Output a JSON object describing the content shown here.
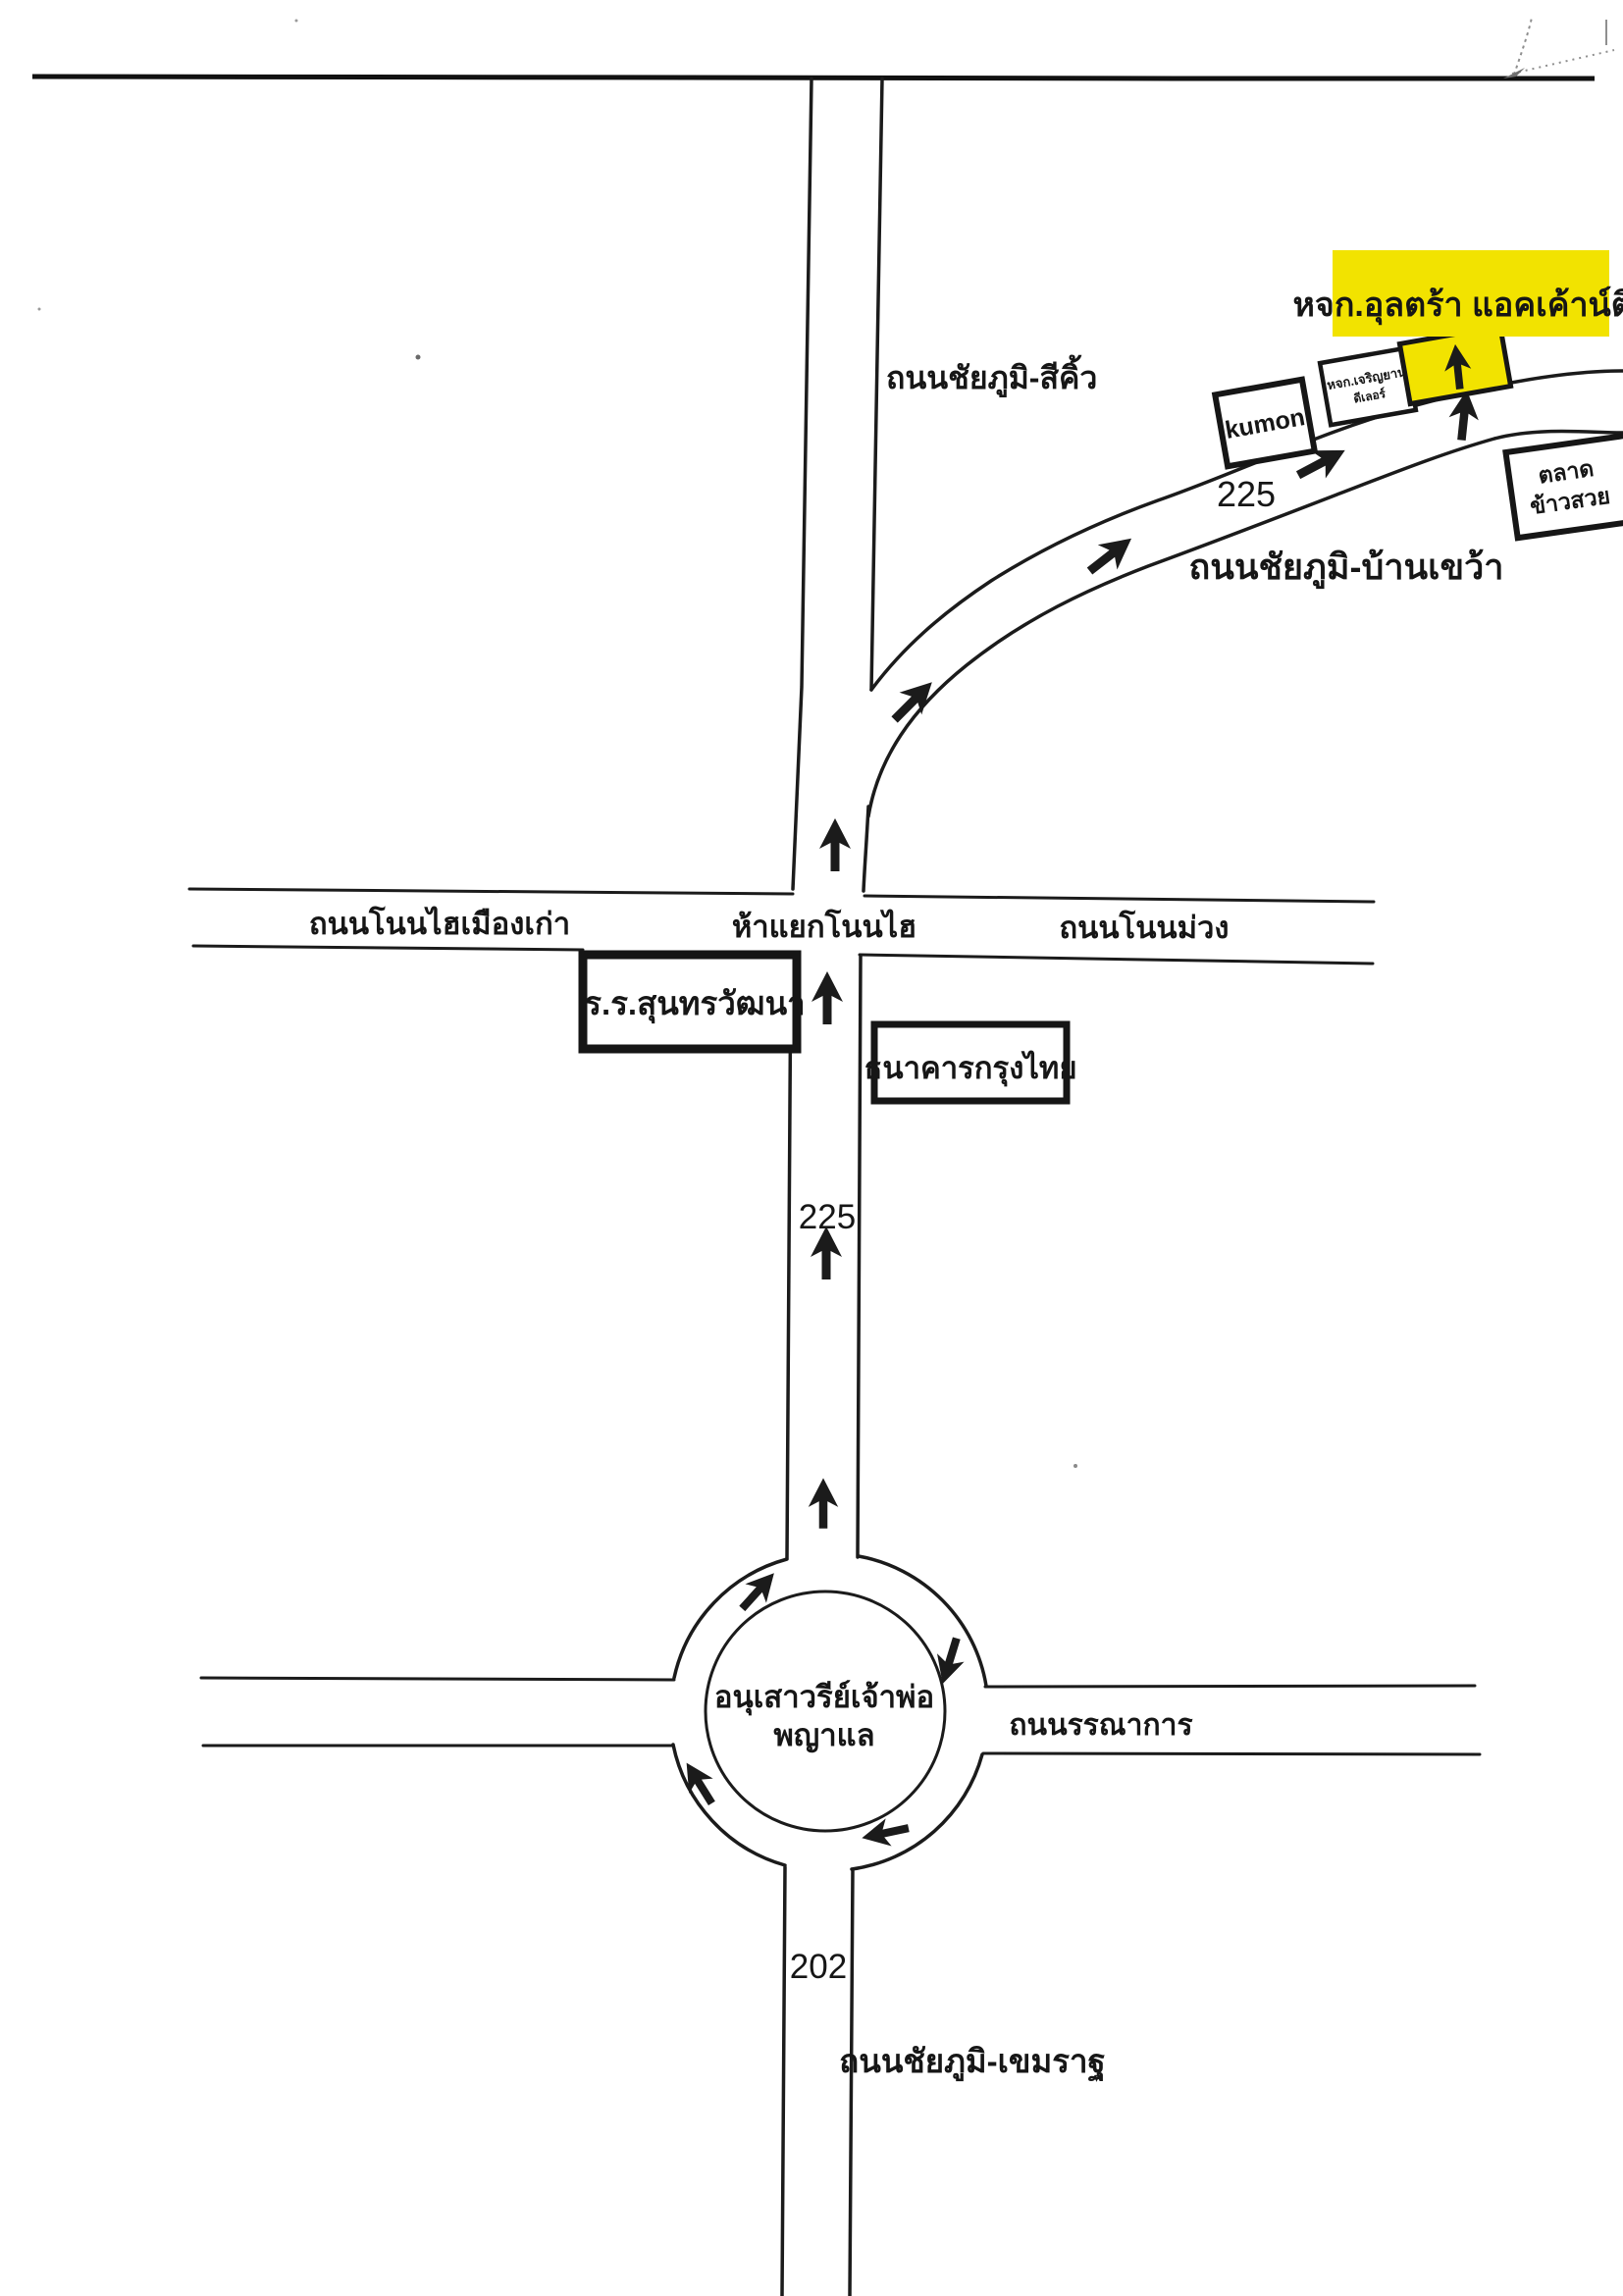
{
  "colors": {
    "ink": "#1b1b1b",
    "highlight": "#f2e300",
    "paper": "#ffffff"
  },
  "destination": {
    "label": "หจก.อุลตร้า แอคเค้าน์ติง"
  },
  "roads": {
    "chaiyaphum_sikhiu": "ถนนชัยภูมิ-สีคิ้ว",
    "chaiyaphum_bankhwao": "ถนนชัยภูมิ-บ้านเขว้า",
    "nonhai_muangkao": "ถนนโนนไฮเมืองเก่า",
    "hayaek_nonhai": "ห้าแยกโนนไฮ",
    "non_muang": "ถนนโนนม่วง",
    "bannakan": "ถนนรรณาการ",
    "chaiyaphum_khemarat": "ถนนชัยภูมิ-เขมราฐ"
  },
  "routes": {
    "r225_top": "225",
    "r225_mid": "225",
    "r202": "202"
  },
  "places": {
    "kumon": "kumon",
    "charoen_line1": "หจก.เจริญยาน",
    "charoen_line2": "ดีเลอร์",
    "market_line1": "ตลาด",
    "market_line2": "ข้าวสวย",
    "school": "ร.ร.สุนทรวัฒนา",
    "bank": "ธนาคารกรุงไทย",
    "monument_line1": "อนุเสาวรีย์เจ้าพ่อ",
    "monument_line2": "พญาแล"
  }
}
